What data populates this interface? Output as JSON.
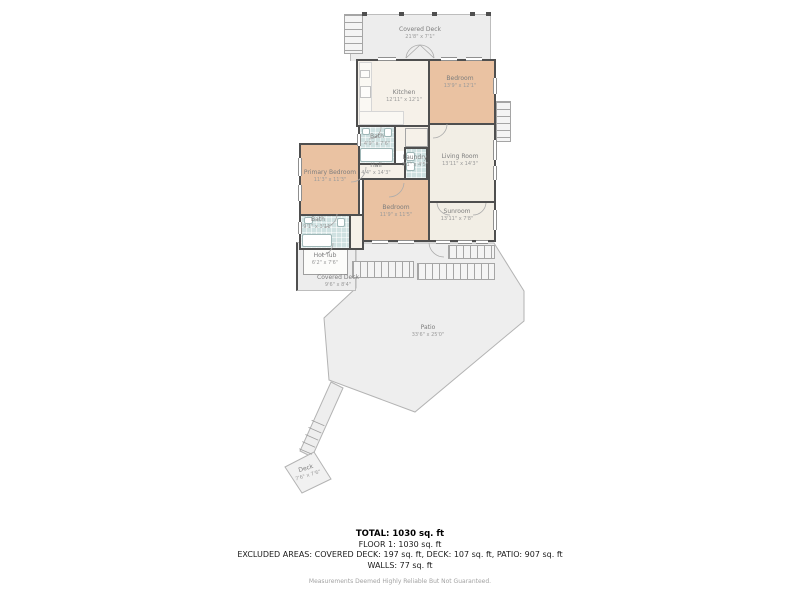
{
  "rooms": {
    "covered_deck_top": {
      "name": "Covered Deck",
      "dims": "21'8\" x 7'1\""
    },
    "kitchen": {
      "name": "Kitchen",
      "dims": "12'11\" x 12'1\""
    },
    "bedroom_top": {
      "name": "Bedroom",
      "dims": "13'9\" x 12'1\""
    },
    "bath_top": {
      "name": "Bath",
      "dims": "4'9\" x 7'6\""
    },
    "hall": {
      "name": "Hall",
      "dims": "4'4\" x 14'3\""
    },
    "laundry": {
      "name": "Laundry",
      "dims": "3'1\" x 4'5\""
    },
    "living_room": {
      "name": "Living Room",
      "dims": "13'11\" x 14'3\""
    },
    "primary_bedroom": {
      "name": "Primary Bedroom",
      "dims": "11'3\" x 11'3\""
    },
    "bath_bottom": {
      "name": "Bath",
      "dims": "9'1\" x 3'11\""
    },
    "bedroom_center": {
      "name": "Bedroom",
      "dims": "11'9\" x 11'5\""
    },
    "sunroom": {
      "name": "Sunroom",
      "dims": "13'11\" x 7'8\""
    },
    "hot_tub": {
      "name": "Hot Tub",
      "dims": "6'2\" x 7'6\""
    },
    "covered_deck_bottom": {
      "name": "Covered Deck",
      "dims": "9'6\" x 8'4\""
    },
    "patio": {
      "name": "Patio",
      "dims": "33'6\" x 25'0\""
    },
    "deck": {
      "name": "Deck",
      "dims": "7'6\" x 7'6\""
    }
  },
  "summary": {
    "total": "TOTAL: 1030 sq. ft",
    "floor1": "FLOOR 1: 1030 sq. ft",
    "excluded": "EXCLUDED AREAS: COVERED DECK: 197 sq. ft, DECK: 107 sq. ft, PATIO: 907 sq. ft",
    "walls": "WALLS: 77 sq. ft",
    "disclaimer": "Measurements Deemed Highly Reliable But Not Guaranteed."
  },
  "palette": {
    "wall": "#4f4f4f",
    "bedroom_fill": "#eac2a2",
    "bath_fill": "#cfe1e1",
    "interior_fill": "#f6f1e9",
    "outdoor_fill": "#ededed",
    "label_text": "#8a8a8a",
    "summary_text": "#1a1a1a",
    "disclaimer_text": "#a3a3a3"
  }
}
